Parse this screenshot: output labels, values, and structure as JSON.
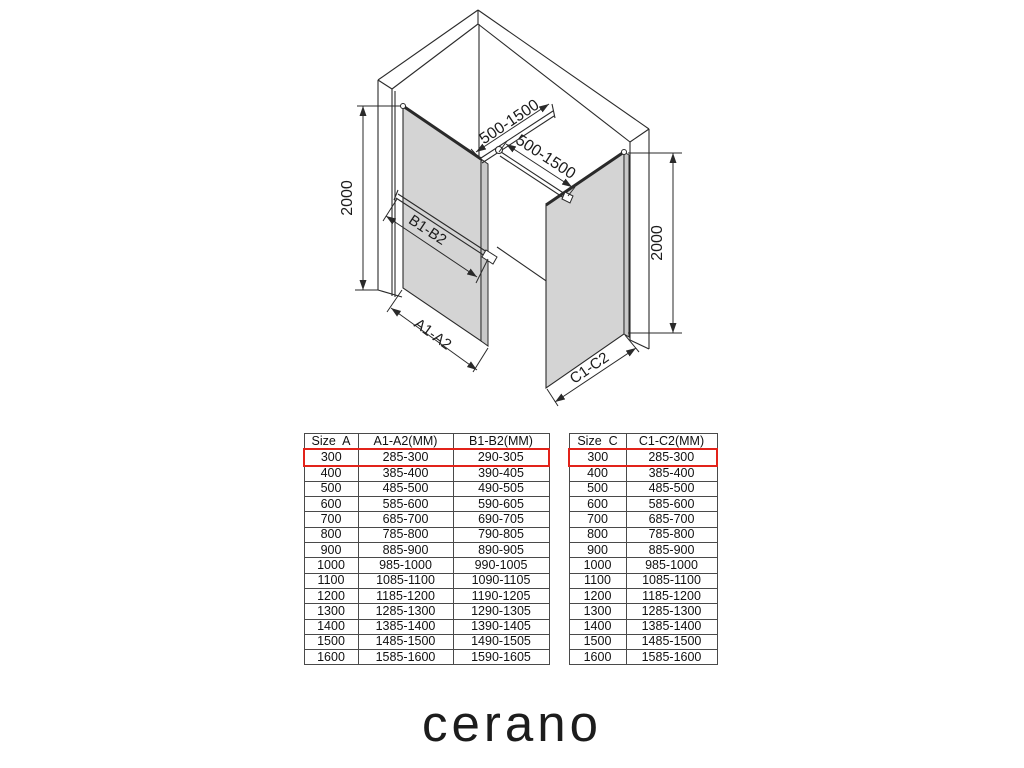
{
  "diagram": {
    "labels": {
      "height_left": "2000",
      "height_right": "2000",
      "bar_left": "500-1500",
      "bar_right": "500-1500",
      "brace": "B1-B2",
      "width_left": "A1-A2",
      "width_right": "C1-C2"
    },
    "colors": {
      "line": "#2a2a2a",
      "glass": "#d4d4d4",
      "glass_edge": "#c8c8c8"
    }
  },
  "tables": {
    "highlight_color": "#e2231a",
    "left": {
      "headers": [
        "Size  A",
        "A1-A2(MM)",
        "B1-B2(MM)"
      ],
      "highlight_row": 0,
      "rows": [
        [
          "300",
          "285-300",
          "290-305"
        ],
        [
          "400",
          "385-400",
          "390-405"
        ],
        [
          "500",
          "485-500",
          "490-505"
        ],
        [
          "600",
          "585-600",
          "590-605"
        ],
        [
          "700",
          "685-700",
          "690-705"
        ],
        [
          "800",
          "785-800",
          "790-805"
        ],
        [
          "900",
          "885-900",
          "890-905"
        ],
        [
          "1000",
          "985-1000",
          "990-1005"
        ],
        [
          "1100",
          "1085-1100",
          "1090-1105"
        ],
        [
          "1200",
          "1185-1200",
          "1190-1205"
        ],
        [
          "1300",
          "1285-1300",
          "1290-1305"
        ],
        [
          "1400",
          "1385-1400",
          "1390-1405"
        ],
        [
          "1500",
          "1485-1500",
          "1490-1505"
        ],
        [
          "1600",
          "1585-1600",
          "1590-1605"
        ]
      ]
    },
    "right": {
      "headers": [
        "Size  C",
        "C1-C2(MM)"
      ],
      "highlight_row": 0,
      "rows": [
        [
          "300",
          "285-300"
        ],
        [
          "400",
          "385-400"
        ],
        [
          "500",
          "485-500"
        ],
        [
          "600",
          "585-600"
        ],
        [
          "700",
          "685-700"
        ],
        [
          "800",
          "785-800"
        ],
        [
          "900",
          "885-900"
        ],
        [
          "1000",
          "985-1000"
        ],
        [
          "1100",
          "1085-1100"
        ],
        [
          "1200",
          "1185-1200"
        ],
        [
          "1300",
          "1285-1300"
        ],
        [
          "1400",
          "1385-1400"
        ],
        [
          "1500",
          "1485-1500"
        ],
        [
          "1600",
          "1585-1600"
        ]
      ]
    }
  },
  "logo": {
    "text": "cerano"
  }
}
